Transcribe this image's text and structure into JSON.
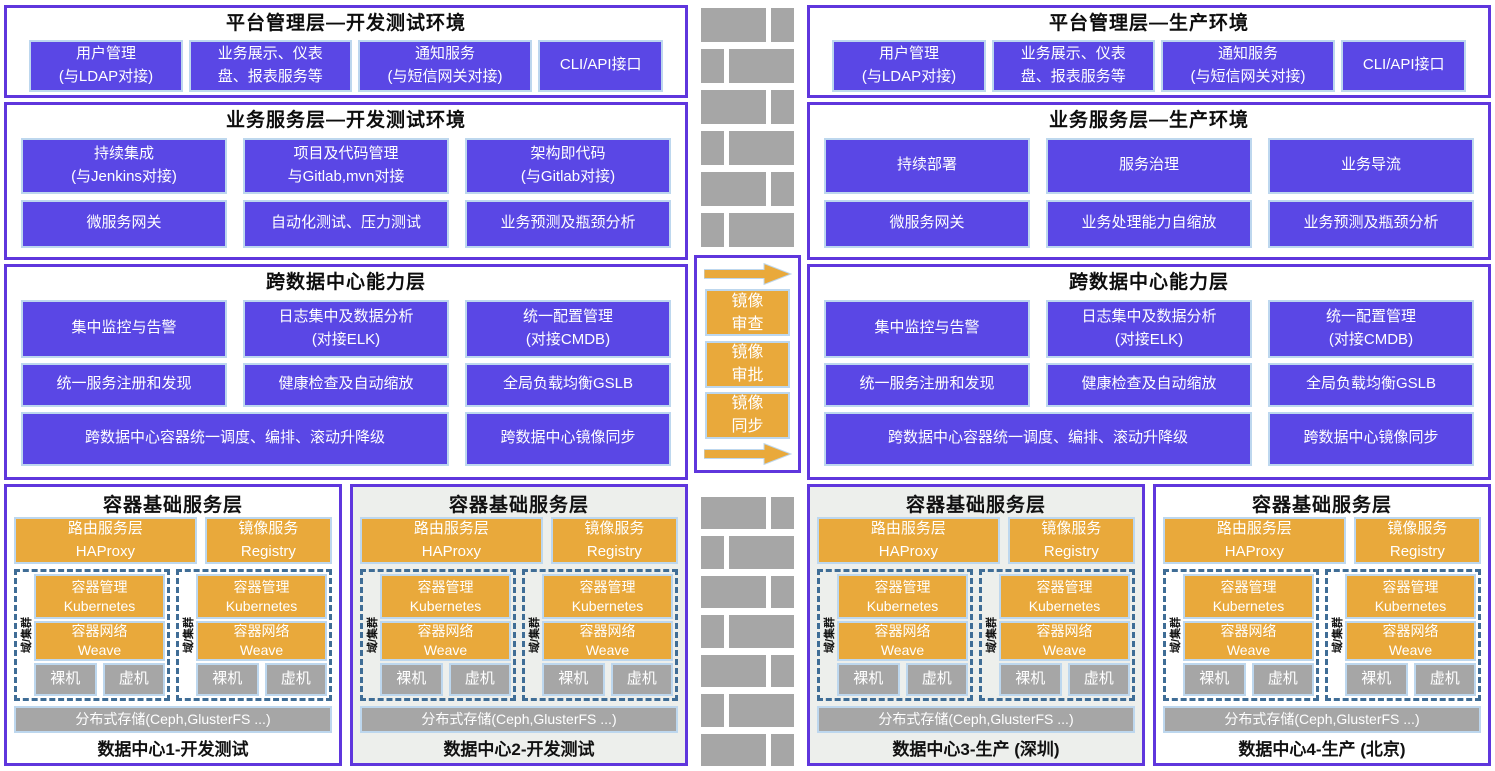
{
  "colors": {
    "box_purple": "#5A47E5",
    "border_purple": "#5F36DD",
    "light_blue_border": "#BDD7EE",
    "orange": "#E9A93B",
    "gray": "#A6A6A6",
    "cluster_dashed_blue": "#3F6D96",
    "dc_alt_background": "#EDEFEC"
  },
  "left": {
    "platform": {
      "title": "平台管理层—开发测试环境",
      "items": [
        "用户管理\n(与LDAP对接)",
        "业务展示、仪表\n盘、报表服务等",
        "通知服务\n(与短信网关对接)",
        "CLI/API接口"
      ]
    },
    "business": {
      "title": "业务服务层—开发测试环境",
      "row1": [
        "持续集成\n(与Jenkins对接)",
        "项目及代码管理\n与Gitlab,mvn对接",
        "架构即代码\n(与Gitlab对接)"
      ],
      "row2": [
        "微服务网关",
        "自动化测试、压力测试",
        "业务预测及瓶颈分析"
      ]
    },
    "crossdc": {
      "title": "跨数据中心能力层",
      "row1": [
        "集中监控与告警",
        "日志集中及数据分析\n(对接ELK)",
        "统一配置管理\n(对接CMDB)"
      ],
      "row2": [
        "统一服务注册和发现",
        "健康检查及自动缩放",
        "全局负载均衡GSLB"
      ],
      "row3": [
        "跨数据中心容器统一调度、编排、滚动升降级",
        "跨数据中心镜像同步"
      ]
    }
  },
  "right": {
    "platform": {
      "title": "平台管理层—生产环境",
      "items": [
        "用户管理\n(与LDAP对接)",
        "业务展示、仪表\n盘、报表服务等",
        "通知服务\n(与短信网关对接)",
        "CLI/API接口"
      ]
    },
    "business": {
      "title": "业务服务层—生产环境",
      "row1": [
        "持续部署",
        "服务治理",
        "业务导流"
      ],
      "row2": [
        "微服务网关",
        "业务处理能力自缩放",
        "业务预测及瓶颈分析"
      ]
    },
    "crossdc": {
      "title": "跨数据中心能力层",
      "row1": [
        "集中监控与告警",
        "日志集中及数据分析\n(对接ELK)",
        "统一配置管理\n(对接CMDB)"
      ],
      "row2": [
        "统一服务注册和发现",
        "健康检查及自动缩放",
        "全局负载均衡GSLB"
      ],
      "row3": [
        "跨数据中心容器统一调度、编排、滚动升降级",
        "跨数据中心镜像同步"
      ]
    }
  },
  "middle": {
    "arrow_labels": [
      "镜像\n审查",
      "镜像\n审批",
      "镜像\n同步"
    ]
  },
  "container_layer": {
    "title": "容器基础服务层",
    "routing": "路由服务层\nHAProxy",
    "registry": "镜像服务\nRegistry",
    "cluster_label": "域/集群",
    "k8s": "容器管理\nKubernetes",
    "network": "容器网络\nWeave",
    "bare_metal": "裸机",
    "vm": "虚机",
    "storage": "分布式存储(Ceph,GlusterFS ...)",
    "datacenters": [
      "数据中心1-开发测试",
      "数据中心2-开发测试",
      "数据中心3-生产 (深圳)",
      "数据中心4-生产 (北京)"
    ]
  }
}
